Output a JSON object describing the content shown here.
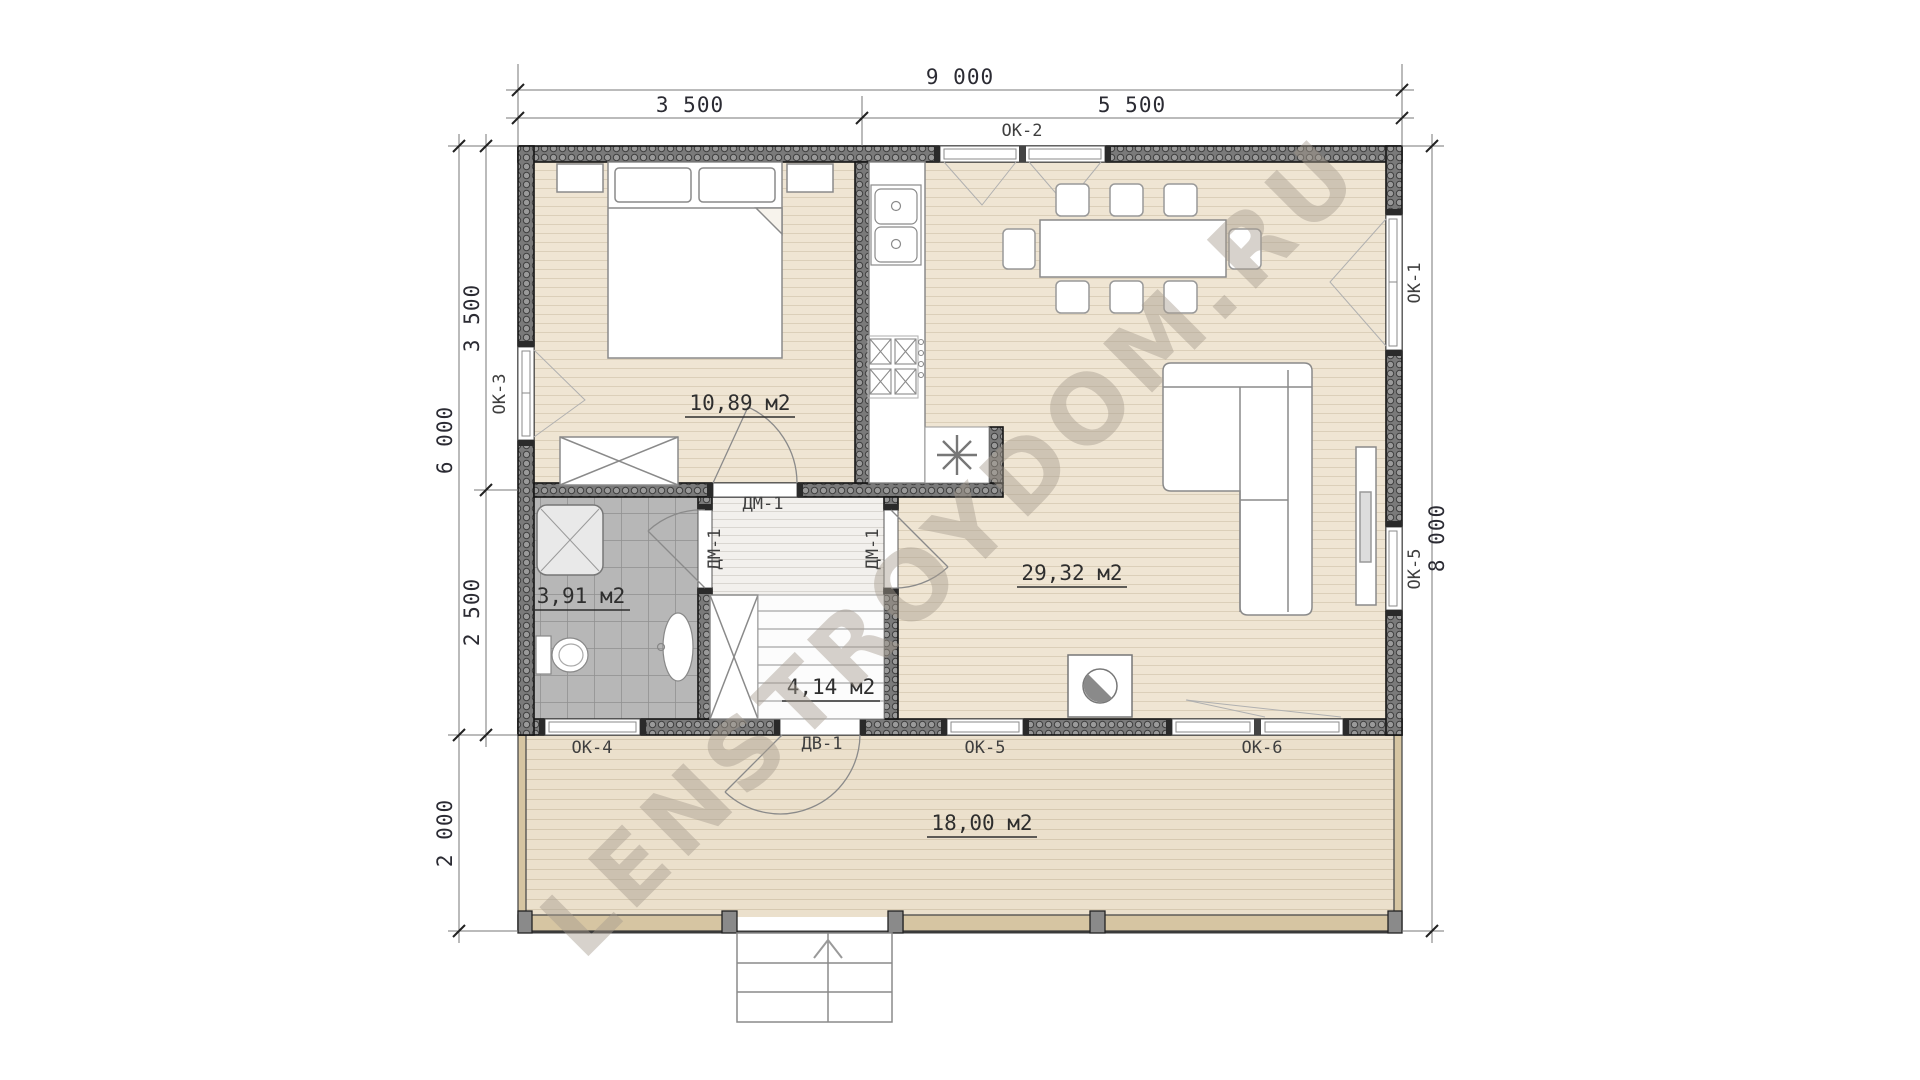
{
  "watermark": "LENSTROYDOM.RU",
  "dimensions": {
    "top_total": "9 000",
    "top_left": "3 500",
    "top_right": "5 500",
    "left_house_height": "6 000",
    "left_terrace_depth": "2 000",
    "left_bedroom_height": "3 500",
    "left_bathroom_height": "2 500",
    "right_total_height": "8 000"
  },
  "rooms": {
    "bedroom": "10,89 м2",
    "living_kitchen": "29,32 м2",
    "bathroom": "3,91 м2",
    "hallway": "4,14 м2",
    "terrace": "18,00 м2"
  },
  "windows": {
    "ok1": "ОК-1",
    "ok2": "ОК-2",
    "ok3": "ОК-3",
    "ok4": "ОК-4",
    "ok5_right": "ОК-5",
    "ok5_bottom": "ОК-5",
    "ok6": "ОК-6"
  },
  "doors": {
    "bedroom": "ДМ-1",
    "bathroom": "ДМ-1",
    "living": "ДМ-1",
    "terrace_entry": "ДВ-1"
  },
  "colors": {
    "wall": "#7a7a7a",
    "floor_wood": "#efe5d3",
    "floor_terrace": "#ebe0cc",
    "floor_tile": "#b7b7b7",
    "hall_floor": "#f2f0ed",
    "railing": "#d6c5a2",
    "dimension_text": "#2b2b33",
    "watermark_tint": "#a79d90"
  }
}
